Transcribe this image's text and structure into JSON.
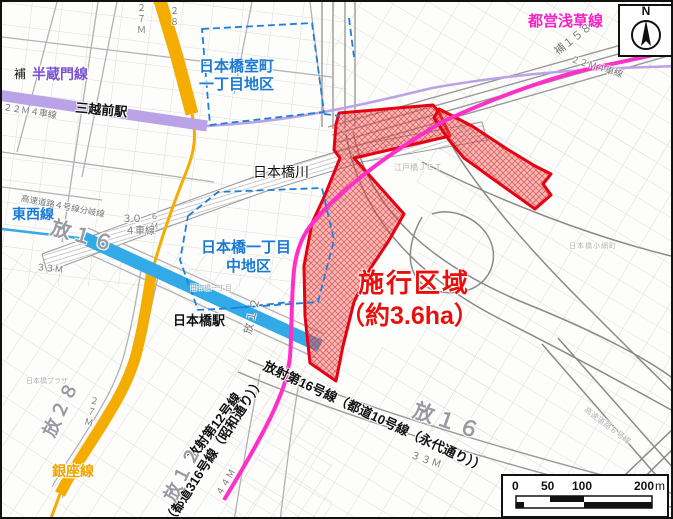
{
  "colors": {
    "project_red": "#e60012",
    "district_blue": "#1a7ad4",
    "hanzomon_purple": "#b9a3e6",
    "tozai_blue": "#33aae8",
    "ginza_yellow": "#f5ac00",
    "asakusa_pink": "#ff2fc8"
  },
  "compass": {
    "north_label": "N"
  },
  "scale_bar": {
    "ticks": [
      "0",
      "50",
      "100",
      "200"
    ],
    "unit": "m"
  },
  "labels": {
    "asakusa_line": "都営浅草線",
    "hanzomon_prefix": "補",
    "hanzomon_line": "半蔵門線",
    "mitsukoshimae_station": "三越前駅",
    "lane_22m_west": "２２Ｍ４車線",
    "width_27m_north": "２７Ｍ",
    "route_28_north": "２８",
    "muromachi_district_line1": "日本橋室町",
    "muromachi_district_line2": "一丁目地区",
    "ho_158": "補１５８",
    "lane_22m_east": "２２Ｍ４車線",
    "nihonbashi_river": "日本橋川",
    "edobashi_jct": "江戸橋ＪＣＴ",
    "tozai_line": "東西線",
    "expressway_branch": "高速道路４号線分岐線",
    "ho_16_west": "放１６",
    "width_30": "３０",
    "width_6m": "６Ｍ",
    "lane_4": "４車線",
    "width_33m_west": "３３Ｍ",
    "naka_district_line1": "日本橋一丁目",
    "naka_district_line2": "中地区",
    "nihonbashi_station": "日本橋駅",
    "ho_12_small": "放１２",
    "nihonbashi_1chome_faint": "日本橋一丁目",
    "nihonbashi_plaza_faint": "日本橋プラザ",
    "project_area_line1": "施行区域",
    "project_area_line2": "（約3.6ha）",
    "hosha_16": "放射第16号線（都道10号線（永代通り））",
    "hosha_12": "放射第12号線",
    "todo_316": "（都道316号線（昭和通り））",
    "ho_12_big": "放１２",
    "width_44m": "４４Ｍ",
    "ginza_line": "銀座線",
    "ho_28_big": "放２８",
    "width_27m_southwest": "２７Ｍ",
    "ho_16_east": "放１６",
    "width_33m_east": "３３Ｍ",
    "expressway_6": "高速道路６号線",
    "koamicho_faint": "日本橋小網町"
  }
}
